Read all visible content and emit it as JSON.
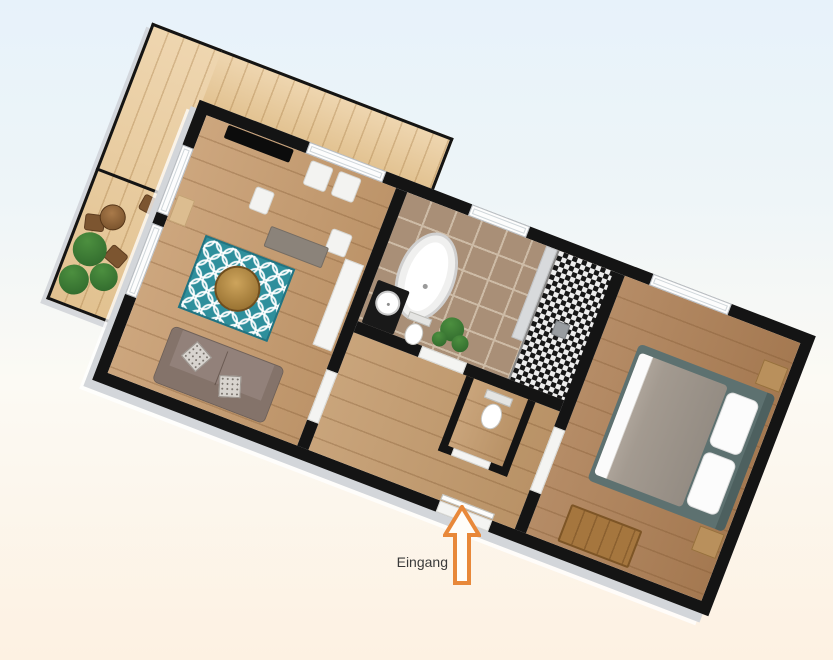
{
  "scene": {
    "type": "3d-floor-plan-rendering",
    "rotation_deg": 21
  },
  "annotation": {
    "entrance_label": "Eingang"
  },
  "palette": {
    "bg_top": "#e7f2fa",
    "bg_mid": "#fcfaf4",
    "bg_bottom": "#fdf1e2",
    "wall": "#141414",
    "wall_shadow": "#d3d6da",
    "deck": "#e9c895",
    "wood_living": "#c79c6f",
    "wood_hall": "#c39a6c",
    "wood_bedroom": "#ad7f55",
    "tile": "#a98f77",
    "grout": "#cdbba6",
    "mosaic_dark": "#161616",
    "mosaic_light": "#ededed",
    "rug": "#2e8f9c",
    "rug_border": "#227381",
    "sofa": "#92817a",
    "sofa_back": "#84736a",
    "bench": "#8b837a",
    "bed_frame": "#5d7170",
    "duvet": "#a39a90",
    "sheet": "#fbfbfb",
    "nightstand": "#b9905c",
    "chest": "#a5763e",
    "plant_light": "#4c8f3f",
    "plant_dark": "#2c642a",
    "tv": "#0c0c0c",
    "cabinet": "#f5f5f3",
    "vanity": "#191919",
    "chair": "#7c5530",
    "arrow": "#e8883a",
    "label_text": "#3a3a3a"
  },
  "rooms": [
    {
      "name": "balcony",
      "furniture": [
        "wood-deck",
        "railing",
        "privacy-divider",
        "plants",
        "bistro-table",
        "chairs"
      ]
    },
    {
      "name": "living-room",
      "furniture": [
        "tv",
        "window-seats",
        "sideboard",
        "rug",
        "round-coffee-table",
        "sofa",
        "throw-pillows",
        "tall-cabinet",
        "wall-shelf",
        "windows"
      ]
    },
    {
      "name": "bathroom",
      "furniture": [
        "freestanding-bathtub",
        "black-vanity-round-basin",
        "toilet",
        "potted-plant",
        "mosaic-shower",
        "window"
      ]
    },
    {
      "name": "hallway",
      "furniture": [
        "entrance-door"
      ]
    },
    {
      "name": "wc",
      "furniture": [
        "toilet"
      ]
    },
    {
      "name": "bedroom",
      "furniture": [
        "double-bed",
        "pillows",
        "nightstands",
        "wooden-chest",
        "window"
      ]
    }
  ]
}
